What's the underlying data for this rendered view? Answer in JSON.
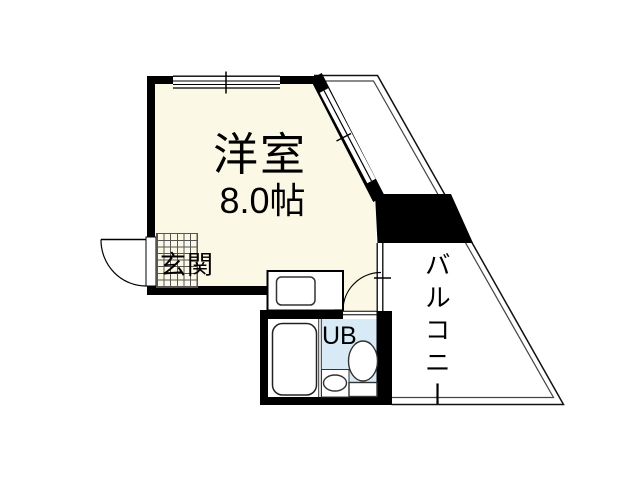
{
  "page": {
    "type": "apartment-floor-plan"
  },
  "colors": {
    "room_fill": "#FCF8E6",
    "ub_floor": "#D8EAF6",
    "wall": "#000000",
    "line": "#222222"
  },
  "rooms": {
    "main_room": {
      "name": "洋室",
      "size": "8.0帖"
    },
    "entrance": {
      "label": "玄関"
    },
    "unit_bath": {
      "label": "UB"
    },
    "balcony": {
      "label": "バルコニー"
    }
  },
  "fixtures": [
    "entrance-door",
    "entrance-tile-grid",
    "window-top",
    "window-diagonal",
    "balcony-window",
    "kitchen-counter",
    "kitchen-sink",
    "bath-door",
    "bathtub",
    "washbasin",
    "toilet"
  ]
}
